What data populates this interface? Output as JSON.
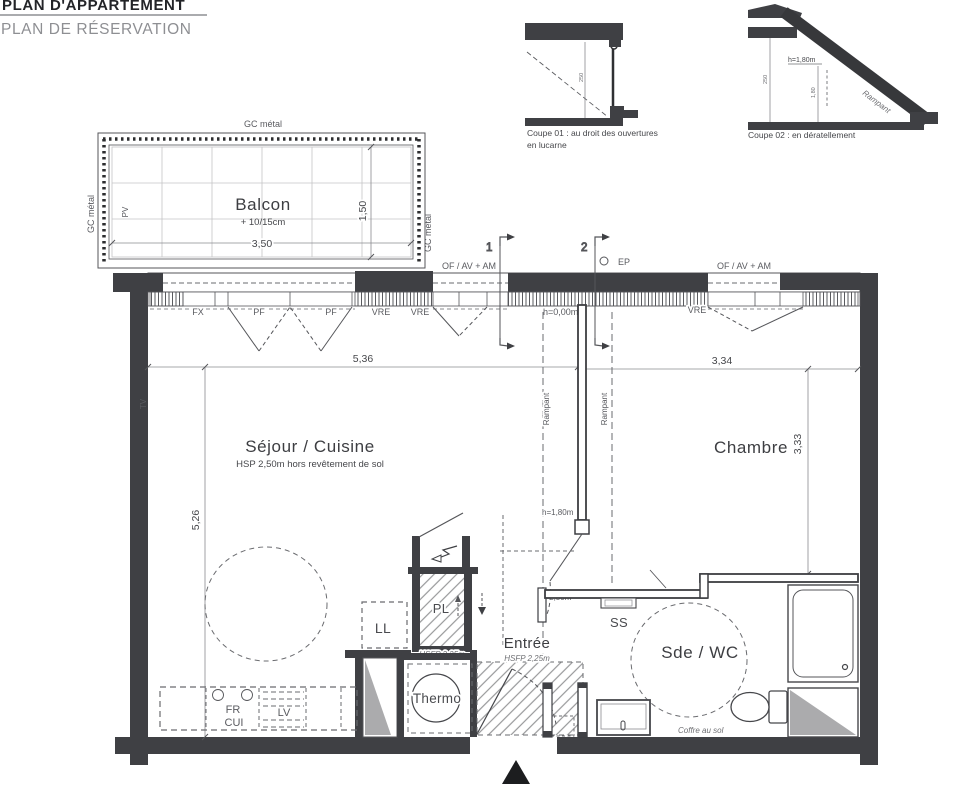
{
  "header": {
    "title_line1": "PLAN D'APPARTEMENT",
    "title_line2": "PLAN DE RÉSERVATION"
  },
  "coupes": {
    "coupe01": {
      "caption_line1": "Coupe 01 : au droit des ouvertures",
      "caption_line2": "en lucarne",
      "dim_height": "250"
    },
    "coupe02": {
      "caption": "Coupe 02 : en dératellement",
      "height_label": "h=1,80m",
      "slope_label": "Rampant",
      "dim_height": "250",
      "dim_inner": "1,80"
    }
  },
  "balcony": {
    "name": "Balcon",
    "level": "+ 10/15cm",
    "dim_width": "3,50",
    "dim_depth": "1,50",
    "rail_top": "GC métal",
    "rail_left": "GC métal",
    "rail_right": "GC métal",
    "pv_label": "PV"
  },
  "plan": {
    "top_labels": {
      "of_av_am_left": "OF / AV + AM",
      "of_av_am_right": "OF / AV + AM",
      "ep": "EP",
      "section1": "1",
      "section2": "2"
    },
    "window_labels": {
      "fx": "FX",
      "pf1": "PF",
      "pf2": "PF",
      "vre1": "VRE",
      "vre2": "VRE",
      "vre3": "VRE",
      "h_zero": "h=0,00m"
    },
    "dims": {
      "sejour_width": "5,36",
      "sejour_depth": "5,26",
      "chambre_width": "3,34",
      "chambre_depth": "3,33"
    },
    "height_labels": {
      "h_180": "h=1,80m",
      "h_250": "h=2,50m"
    },
    "slope_labels": {
      "rampant_left": "Rampant",
      "rampant_right": "Rampant"
    },
    "rooms": {
      "sejour": {
        "name": "Séjour / Cuisine",
        "sub": "HSP 2,50m hors revêtement de sol",
        "tv_label": "TV"
      },
      "chambre": {
        "name": "Chambre"
      },
      "entree": {
        "name": "Entrée",
        "sub": "HSFP 2,25m"
      },
      "sde_wc": {
        "name": "Sde / WC",
        "coffre_label": "Coffre au sol"
      },
      "thermo": {
        "name": "Thermo"
      },
      "placard": {
        "name": "PL",
        "sub": "HSFP 2,25m"
      },
      "ll": {
        "name": "LL"
      },
      "ss": {
        "name": "SS"
      },
      "kitchen": {
        "fr": "FR",
        "cui": "CUI",
        "lv": "LV"
      }
    }
  }
}
